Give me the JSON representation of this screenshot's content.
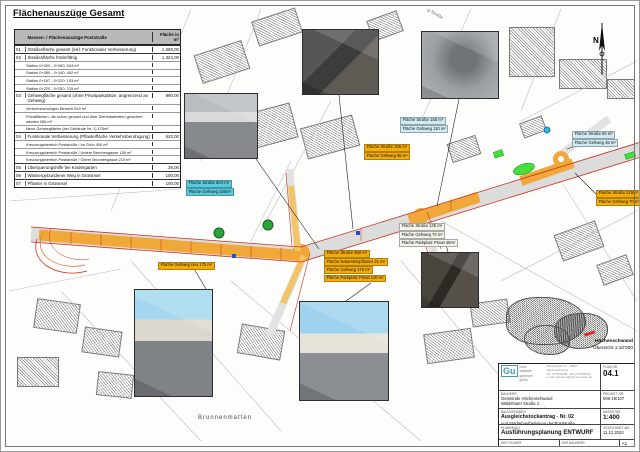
{
  "page": {
    "title": "Flächenauszüge Gesamt",
    "bottom_label": "Brunnenmatten",
    "street_label": "g-Straße",
    "north_letter": "N",
    "accent_colors": {
      "road_orange": "#f0a838",
      "edge_red": "#d03020",
      "green_area": "#44e03c",
      "callout_cyan": "#55cbe0",
      "callout_yellow": "#f6ac00"
    }
  },
  "table": {
    "header": {
      "col1": "Massen- / Flächenauszüge Poststraße",
      "col2": "Fläche in m²"
    },
    "rows": [
      {
        "no": "01",
        "label": "Straßenfläche gesamt (inkl. Funktionaler Verbesserung)",
        "value": "1.669,00",
        "sub": []
      },
      {
        "no": "02",
        "label": "Straßenfläche förderfähig",
        "value": "1.324,00",
        "sub": [
          "Station 0+000 - 0+080:   504 m²",
          "Station 0+080 - 0+140:   492 m²",
          "Station 0+167 - 0+220:   193 m²",
          "Station 0+220 - 0+250:   215 m²"
        ]
      },
      {
        "no": "03",
        "label": "Gehwegfläche gesamt (ohne Privatparkplätze, angrenzend an Gehweg)",
        "value": "990,00",
        "sub": [
          "Verkehrsberuhigter Bereich 519 m²",
          "Privatflächen, die schon genutzt und über Dienstbarkeiten gesichert werden 266 m²",
          "Neue Gehwegfläche (bei Gebäude Nr. 1) 175m²"
        ]
      },
      {
        "no": "04",
        "label": "Funktionale Verbesserung (Pflasterfläche Verkehrsberuhigung)",
        "value": "620,00",
        "sub": [
          "Kreuzungsbereich Poststraße / Im Grün 450 m²",
          "Kreuzungsbereich Poststraße / Untere Brunnengasse 155 m²",
          "Kreuzungsbereich Poststraße / Obere Brunnengasse 215 m²"
        ]
      },
      {
        "no": "05",
        "label": "Überquerungshilfe bei Kindergarten",
        "value": "36,00",
        "sub": []
      },
      {
        "no": "06",
        "label": "Wassergebundener Weg in Grüninsel",
        "value": "100,00",
        "sub": []
      },
      {
        "no": "07",
        "label": "Pflaster in Grüninsel",
        "value": "100,00",
        "sub": []
      }
    ]
  },
  "callouts": [
    {
      "style": "cyan",
      "lines": [
        "Fläche Straße 504 m²",
        "Fläche Gehweg 230m²"
      ]
    },
    {
      "style": "palecyan",
      "lines": [
        "Fläche Straße 155 m²",
        "Fläche Gehweg 110 m²"
      ]
    },
    {
      "style": "palecyan",
      "lines": [
        "Fläche Straße 55 m²",
        "Fläche Gehweg 45 m²"
      ]
    },
    {
      "style": "yellow",
      "lines": [
        "Fläche Straße 155 m²",
        "Fläche Gehweg 85 m²"
      ]
    },
    {
      "style": "yellow",
      "lines": [
        "Fläche Straße 215m²",
        "Fläche Gehweg 70m²"
      ]
    },
    {
      "style": "yellow",
      "lines": [
        "Fläche Straße 450 m²",
        "Fläche Natursteinpflaster 21 m²",
        "Fläche Gehweg 175 m²",
        "Fläche Parkplatz Privat 110 m²"
      ]
    },
    {
      "style": "white",
      "lines": [
        "Fläche Straße 135 m²",
        "Fläche Gehweg 70 m²",
        "Fläche Parkplatz Privat 45m²"
      ]
    },
    {
      "style": "yellow",
      "lines": [
        "Fläche Gehweg neu 175 m²"
      ]
    }
  ],
  "overview": {
    "town": "Höchenschwand",
    "scale": "Übersicht 1:10'000"
  },
  "titleblock": {
    "firm": {
      "glyph": "Gu",
      "lines": [
        "heitz",
        "wäschle",
        "gutmann gmbh"
      ],
      "contact1": "Hauptstraße 14 · 79862 Höchenschwand",
      "contact2": "Tel. 07755/8138 · Fax 07755/8139",
      "contact3": "e-mail: gutmann@gutmann-plan.de"
    },
    "plannr_label": "Plan-Nr.",
    "plannr": "04.1",
    "projekt_label": "Projekt-Nr.",
    "projekt": "006-19/107",
    "bauherr_label": "Bauherr",
    "bauherr1": "Gemeinde Höchenschwand",
    "bauherr2": "Waldshuter Straße 2",
    "bauherr3": "79862 Höchenschwand",
    "vorhaben_label": "Bauvorhaben",
    "vorhaben1": "Ausgleichstockantrag - Nr. 02",
    "vorhaben2": "und Städtebauförderung der Poststraße",
    "inhalt_label": "Planinhalt",
    "inhalt": "Ausführungsplanung ENTWURF",
    "massstab_label": "Maßstab",
    "massstab": "1:400",
    "datum_label": "gezeichnet am",
    "datum": "11.12.2020",
    "planer_label": "Der Planer",
    "bauherr_sig_label": "Der Bauherr",
    "format": "A1"
  }
}
